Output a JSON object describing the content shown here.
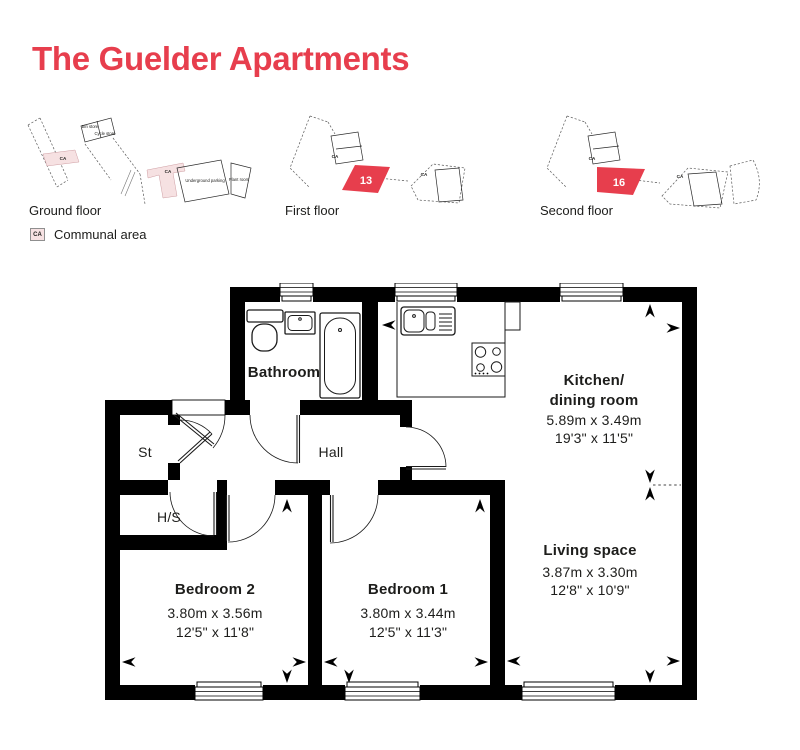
{
  "title": "The Guelder Apartments",
  "colors": {
    "accent": "#e73e4d",
    "communal": "#f6e1e2",
    "wall": "#000000",
    "ink": "#1d1d1b"
  },
  "thumbnails": [
    {
      "label": "Ground floor",
      "annotations": {
        "bin_store": "Bin store",
        "cycle_store": "Cycle store",
        "ca_left": "CA",
        "ca_right": "CA",
        "underground_parking": "Underground parking",
        "plant_room": "Plant room"
      }
    },
    {
      "label": "First floor",
      "unit": "13",
      "ca_left": "CA",
      "ca_right": "CA"
    },
    {
      "label": "Second floor",
      "unit": "16",
      "ca_left": "CA",
      "ca_right": "CA"
    }
  ],
  "legend": {
    "key": "CA",
    "label": "Communal area"
  },
  "plan": {
    "rooms": {
      "bathroom": {
        "name": "Bathroom"
      },
      "st": {
        "name": "St"
      },
      "hs": {
        "name": "H/S"
      },
      "hall": {
        "name": "Hall"
      },
      "kitchen": {
        "name_line1": "Kitchen/",
        "name_line2": "dining room",
        "metric": "5.89m x 3.49m",
        "imperial": "19'3\" x 11'5\""
      },
      "living": {
        "name": "Living space",
        "metric": "3.87m x 3.30m",
        "imperial": "12'8\" x 10'9\""
      },
      "bedroom2": {
        "name": "Bedroom 2",
        "metric": "3.80m x 3.56m",
        "imperial": "12'5\" x 11'8\""
      },
      "bedroom1": {
        "name": "Bedroom 1",
        "metric": "3.80m x 3.44m",
        "imperial": "12'5\" x 11'3\""
      }
    }
  }
}
